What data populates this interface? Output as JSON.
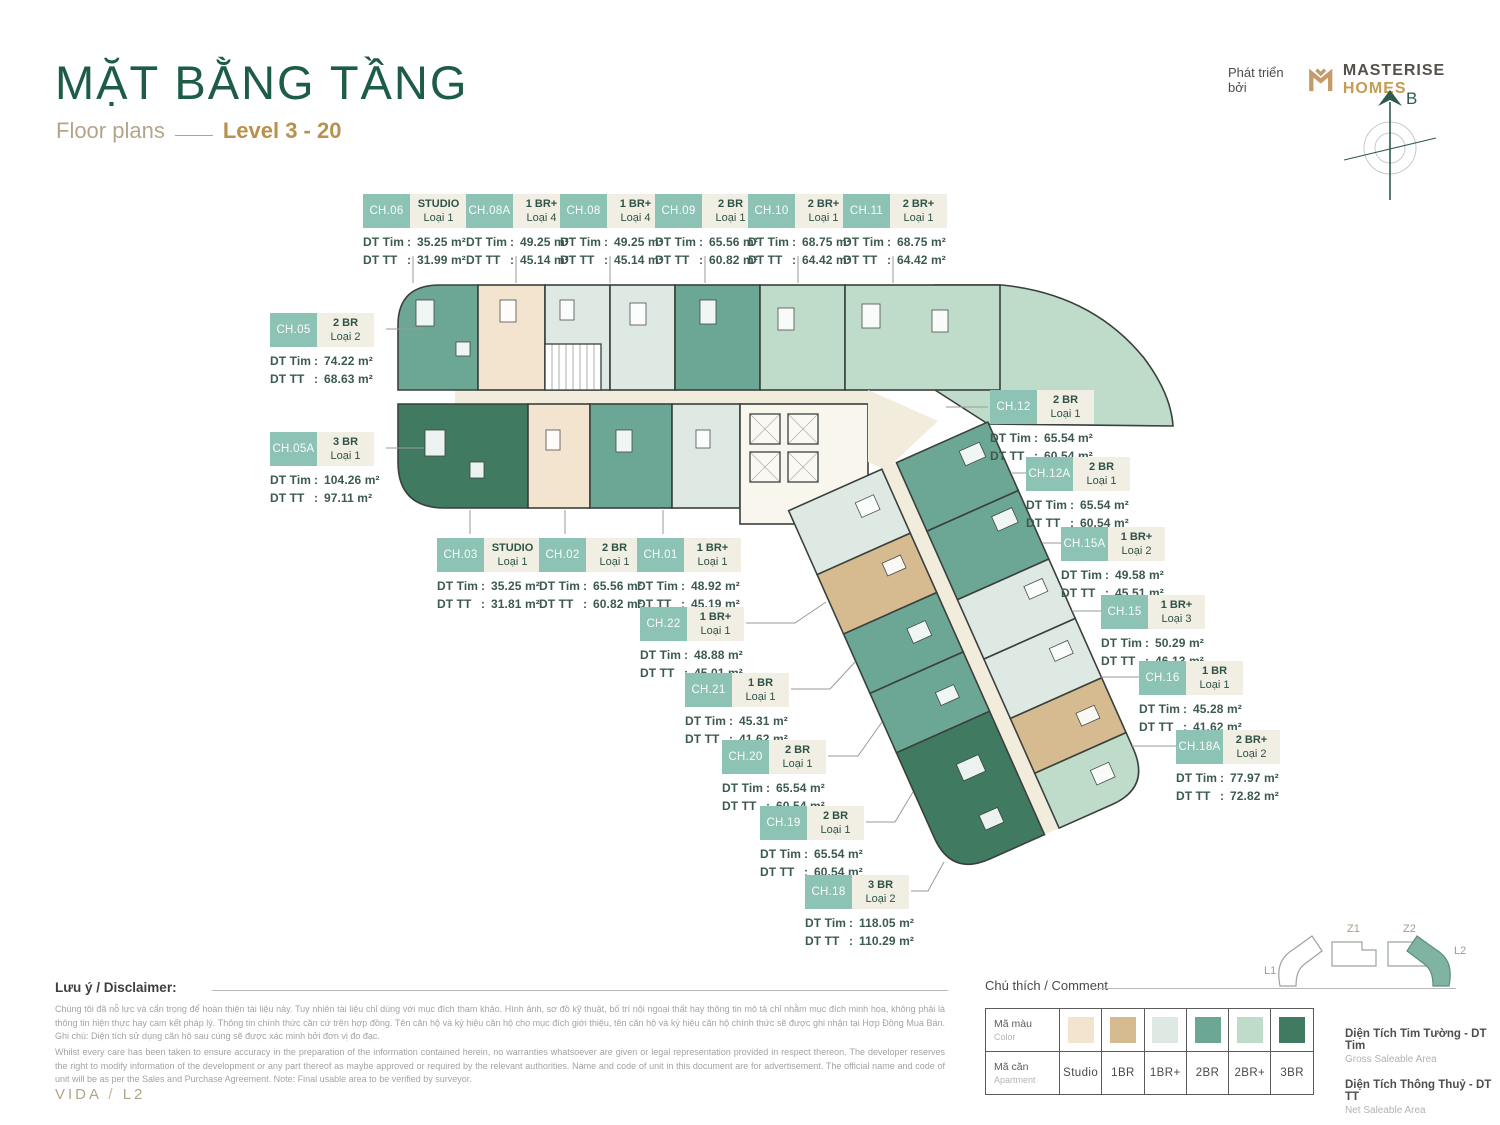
{
  "header": {
    "title": "MẶT BẰNG TẦNG",
    "subtitle": "Floor plans",
    "level": "Level 3 - 20",
    "developer_prefix": "Phát triển bởi",
    "brand_name": "MASTERISE",
    "brand_suffix": "HOMES",
    "compass_label": "B"
  },
  "labels": {
    "dt_tim": "DT Tim",
    "dt_tt": "DT TT",
    "colon": ":"
  },
  "units": [
    {
      "id": "CH.06",
      "type": "STUDIO",
      "loai": "Loại 1",
      "tim": "35.25 m²",
      "tt": "31.99 m²"
    },
    {
      "id": "CH.08A",
      "type": "1 BR+",
      "loai": "Loại 4",
      "tim": "49.25 m²",
      "tt": "45.14 m²"
    },
    {
      "id": "CH.08",
      "type": "1 BR+",
      "loai": "Loại 4",
      "tim": "49.25 m²",
      "tt": "45.14 m²"
    },
    {
      "id": "CH.09",
      "type": "2 BR",
      "loai": "Loại 1",
      "tim": "65.56 m²",
      "tt": "60.82 m²"
    },
    {
      "id": "CH.10",
      "type": "2 BR+",
      "loai": "Loại 1",
      "tim": "68.75 m²",
      "tt": "64.42 m²"
    },
    {
      "id": "CH.11",
      "type": "2 BR+",
      "loai": "Loại 1",
      "tim": "68.75 m²",
      "tt": "64.42 m²"
    },
    {
      "id": "CH.05",
      "type": "2 BR",
      "loai": "Loại 2",
      "tim": "74.22 m²",
      "tt": "68.63 m²"
    },
    {
      "id": "CH.05A",
      "type": "3 BR",
      "loai": "Loại 1",
      "tim": "104.26 m²",
      "tt": "97.11 m²"
    },
    {
      "id": "CH.03",
      "type": "STUDIO",
      "loai": "Loại 1",
      "tim": "35.25 m²",
      "tt": "31.81 m²"
    },
    {
      "id": "CH.02",
      "type": "2 BR",
      "loai": "Loại 1",
      "tim": "65.56 m²",
      "tt": "60.82 m²"
    },
    {
      "id": "CH.01",
      "type": "1 BR+",
      "loai": "Loại 1",
      "tim": "48.92 m²",
      "tt": "45.19 m²"
    },
    {
      "id": "CH.22",
      "type": "1 BR+",
      "loai": "Loại 1",
      "tim": "48.88 m²",
      "tt": "45.01 m²"
    },
    {
      "id": "CH.21",
      "type": "1 BR",
      "loai": "Loại 1",
      "tim": "45.31 m²",
      "tt": "41.62 m²"
    },
    {
      "id": "CH.20",
      "type": "2 BR",
      "loai": "Loại 1",
      "tim": "65.54 m²",
      "tt": "60.54 m²"
    },
    {
      "id": "CH.19",
      "type": "2 BR",
      "loai": "Loại 1",
      "tim": "65.54 m²",
      "tt": "60.54 m²"
    },
    {
      "id": "CH.18",
      "type": "3 BR",
      "loai": "Loại 2",
      "tim": "118.05 m²",
      "tt": "110.29 m²"
    },
    {
      "id": "CH.12",
      "type": "2 BR",
      "loai": "Loại 1",
      "tim": "65.54 m²",
      "tt": "60.54 m²"
    },
    {
      "id": "CH.12A",
      "type": "2 BR",
      "loai": "Loại 1",
      "tim": "65.54 m²",
      "tt": "60.54 m²"
    },
    {
      "id": "CH.15A",
      "type": "1 BR+",
      "loai": "Loại 2",
      "tim": "49.58 m²",
      "tt": "45.51 m²"
    },
    {
      "id": "CH.15",
      "type": "1 BR+",
      "loai": "Loại 3",
      "tim": "50.29 m²",
      "tt": "46.13 m²"
    },
    {
      "id": "CH.16",
      "type": "1 BR",
      "loai": "Loại 1",
      "tim": "45.28 m²",
      "tt": "41.62 m²"
    },
    {
      "id": "CH.18A",
      "type": "2 BR+",
      "loai": "Loại 2",
      "tim": "77.97 m²",
      "tt": "72.82 m²"
    }
  ],
  "disclaimer": {
    "heading": "Lưu ý / Disclaimer:",
    "vi": "Chúng tôi đã nỗ lực và cẩn trọng để hoàn thiện tài liệu này. Tuy nhiên tài liệu chỉ dùng với mục đích tham khảo. Hình ảnh, sơ đồ kỹ thuật, bố trí nội ngoại thất hay thông tin mô tả chỉ nhằm mục đích minh họa, không phải là thông tin hiện thực hay cam kết pháp lý. Thông tin chính thức căn cứ trên hợp đồng. Tên căn hộ và ký hiệu căn hộ cho mục đích giới thiệu, tên căn hộ và ký hiệu căn hộ chính thức sẽ được ghi nhận tại Hợp Đồng Mua Bán. Ghi chú: Diện tích sử dụng căn hộ sau cùng sẽ được xác minh bởi đơn vị đo đạc.",
    "en": "Whilst every care has been taken to ensure accuracy in the preparation of the information contained herein, no warranties whatsoever are given or legal representation provided in respect thereon. The developer reserves the right to modify information of the development or any part thereof as maybe approved or required by the relevant authorities. Name and code of unit in this document are for advertisement. The official name and code of unit will be as per the Sales and Purchase Agreement. Note: Final usable area to be verified by surveyor."
  },
  "legend": {
    "heading": "Chú thích / Comment",
    "color_row": {
      "vi": "Mã màu",
      "en": "Color"
    },
    "apt_row": {
      "vi": "Mã căn",
      "en": "Apartment"
    },
    "items": [
      {
        "name": "Studio",
        "color": "#f2e4cf"
      },
      {
        "name": "1BR",
        "color": "#d6ba90"
      },
      {
        "name": "1BR+",
        "color": "#dee9e4"
      },
      {
        "name": "2BR",
        "color": "#6ca795"
      },
      {
        "name": "2BR+",
        "color": "#bfdcca"
      },
      {
        "name": "3BR",
        "color": "#3f7a61"
      }
    ],
    "notes": [
      {
        "vi": "Diện Tích Tim Tường - DT Tim",
        "en": "Gross Saleable Area"
      },
      {
        "vi": "Diện Tích Thông Thuỷ - DT TT",
        "en": "Net Saleable Area"
      }
    ]
  },
  "locator": {
    "items": [
      "L1",
      "Z1",
      "Z2",
      "L2"
    ],
    "active": "L2"
  },
  "footer": {
    "project": "VIDA",
    "sep": "/",
    "zone": "L2"
  },
  "colors": {
    "accent_green": "#1d5c45",
    "gold": "#b8914f",
    "chip_teal": "#8cc3b4",
    "teal": "#6ca795",
    "mint": "#bfdcca",
    "pale": "#dee9e4",
    "cream": "#f2e4cf",
    "tan": "#d6ba90",
    "dark_green": "#3f7a61",
    "corridor": "#f2ecdd"
  }
}
